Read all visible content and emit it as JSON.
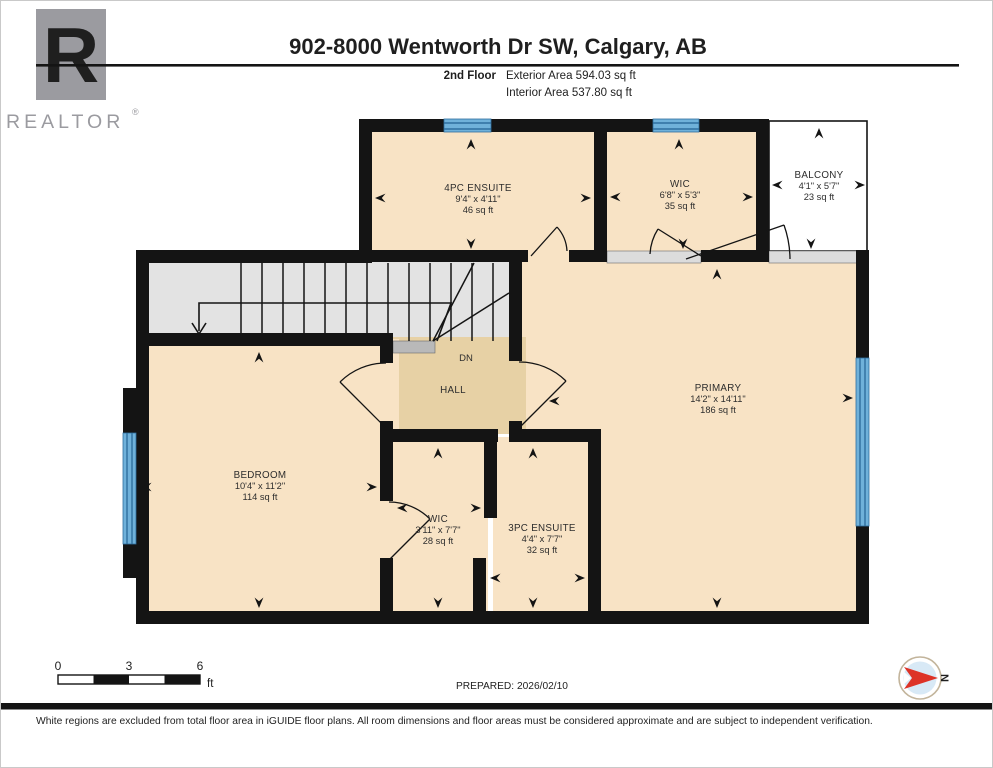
{
  "header": {
    "logo": {
      "letter": "R",
      "label": "REALTOR",
      "registered": "®"
    },
    "title": "902-8000 Wentworth Dr SW, Calgary, AB",
    "floor_label": "2nd Floor",
    "exterior_area": "Exterior Area 594.03 sq ft",
    "interior_area": "Interior Area 537.80 sq ft"
  },
  "rooms": {
    "ensuite4": {
      "name": "4PC ENSUITE",
      "dims": "9'4\" x 4'11\"",
      "area": "46 sq ft"
    },
    "wic_top": {
      "name": "WIC",
      "dims": "6'8\" x 5'3\"",
      "area": "35 sq ft"
    },
    "balcony": {
      "name": "BALCONY",
      "dims": "4'1\" x 5'7\"",
      "area": "23 sq ft"
    },
    "primary": {
      "name": "PRIMARY",
      "dims": "14'2\" x 14'11\"",
      "area": "186 sq ft"
    },
    "bedroom": {
      "name": "BEDROOM",
      "dims": "10'4\" x 11'2\"",
      "area": "114 sq ft"
    },
    "hall": {
      "name": "HALL"
    },
    "stairs": {
      "label": "DN"
    },
    "wic_bottom": {
      "name": "WIC",
      "dims": "3'11\" x 7'7\"",
      "area": "28 sq ft"
    },
    "ensuite3": {
      "name": "3PC ENSUITE",
      "dims": "4'4\" x 7'7\"",
      "area": "32 sq ft"
    }
  },
  "footer": {
    "scale": {
      "t0": "0",
      "t3": "3",
      "t6": "6",
      "unit": "ft"
    },
    "prepared": "PREPARED: 2026/02/10",
    "compass_n": "N",
    "disclaimer": "White regions are excluded from total floor area in iGUIDE floor plans. All room dimensions and floor areas must be considered approximate and are subject to independent verification."
  },
  "colors": {
    "room_fill": "#f8e3c5",
    "hall_fill": "#e7d1a5",
    "stairs_gray": "#e3e3e3",
    "sill_gray": "#dcdcdc",
    "wall_black": "#141414",
    "window_blue": "#6fb1da",
    "compass_red": "#dd3327",
    "logo_gray": "#9b9ba0"
  }
}
